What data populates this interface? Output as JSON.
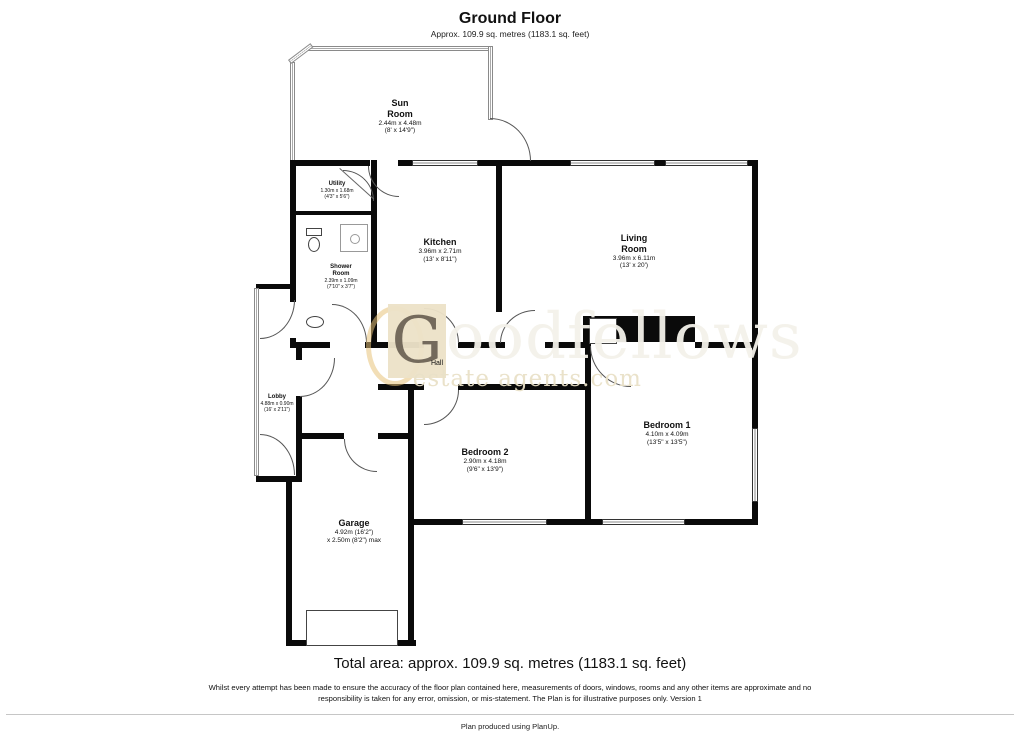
{
  "header": {
    "title": "Ground Floor",
    "subtitle": "Approx. 109.9 sq. metres (1183.1 sq. feet)"
  },
  "rooms": {
    "sun_room": {
      "name": "Sun\nRoom",
      "metric": "2.44m x 4.48m",
      "imperial": "(8' x 14'9\")"
    },
    "utility": {
      "name": "Utility",
      "metric": "1.30m x 1.68m",
      "imperial": "(4'3\" x 5'6\")"
    },
    "kitchen": {
      "name": "Kitchen",
      "metric": "3.96m x 2.71m",
      "imperial": "(13' x 8'11\")"
    },
    "living_room": {
      "name": "Living\nRoom",
      "metric": "3.96m x 6.11m",
      "imperial": "(13' x 20')"
    },
    "shower_room": {
      "name": "Shower\nRoom",
      "metric": "2.39m x 1.09m",
      "imperial": "(7'10\" x 3'7\")"
    },
    "hall": {
      "name": "Hall"
    },
    "lobby": {
      "name": "Lobby",
      "metric": "4.88m x 0.90m",
      "imperial": "(16' x 2'11\")"
    },
    "bedroom_1": {
      "name": "Bedroom 1",
      "metric": "4.10m x 4.09m",
      "imperial": "(13'5\" x 13'5\")"
    },
    "bedroom_2": {
      "name": "Bedroom 2",
      "metric": "2.90m x 4.18m",
      "imperial": "(9'6\" x 13'9\")"
    },
    "garage": {
      "name": "Garage",
      "metric": "4.92m (16'2\")",
      "imperial": "x 2.50m (8'2\") max"
    }
  },
  "watermark": {
    "initial": "G",
    "rest": "oodfellows",
    "tagline": "estate agents.com"
  },
  "footer": {
    "total": "Total area: approx. 109.9 sq. metres (1183.1 sq. feet)",
    "disclaimer_line1": "Whilst every attempt has been made to ensure the accuracy of the floor plan contained here, measurements of doors, windows, rooms and any other items are approximate and no",
    "disclaimer_line2": "responsibility is taken for any error, omission, or mis-statement. The Plan is for illustrative purposes only. Version 1",
    "credit": "Plan produced using PlanUp."
  },
  "colors": {
    "wall": "#0a0a0a",
    "window_border": "#333333",
    "watermark_square": "#ece2c8",
    "watermark_text": "#f3f1ea",
    "watermark_tagline": "#e9e0c7",
    "accent_ring": "#e7c27a"
  }
}
